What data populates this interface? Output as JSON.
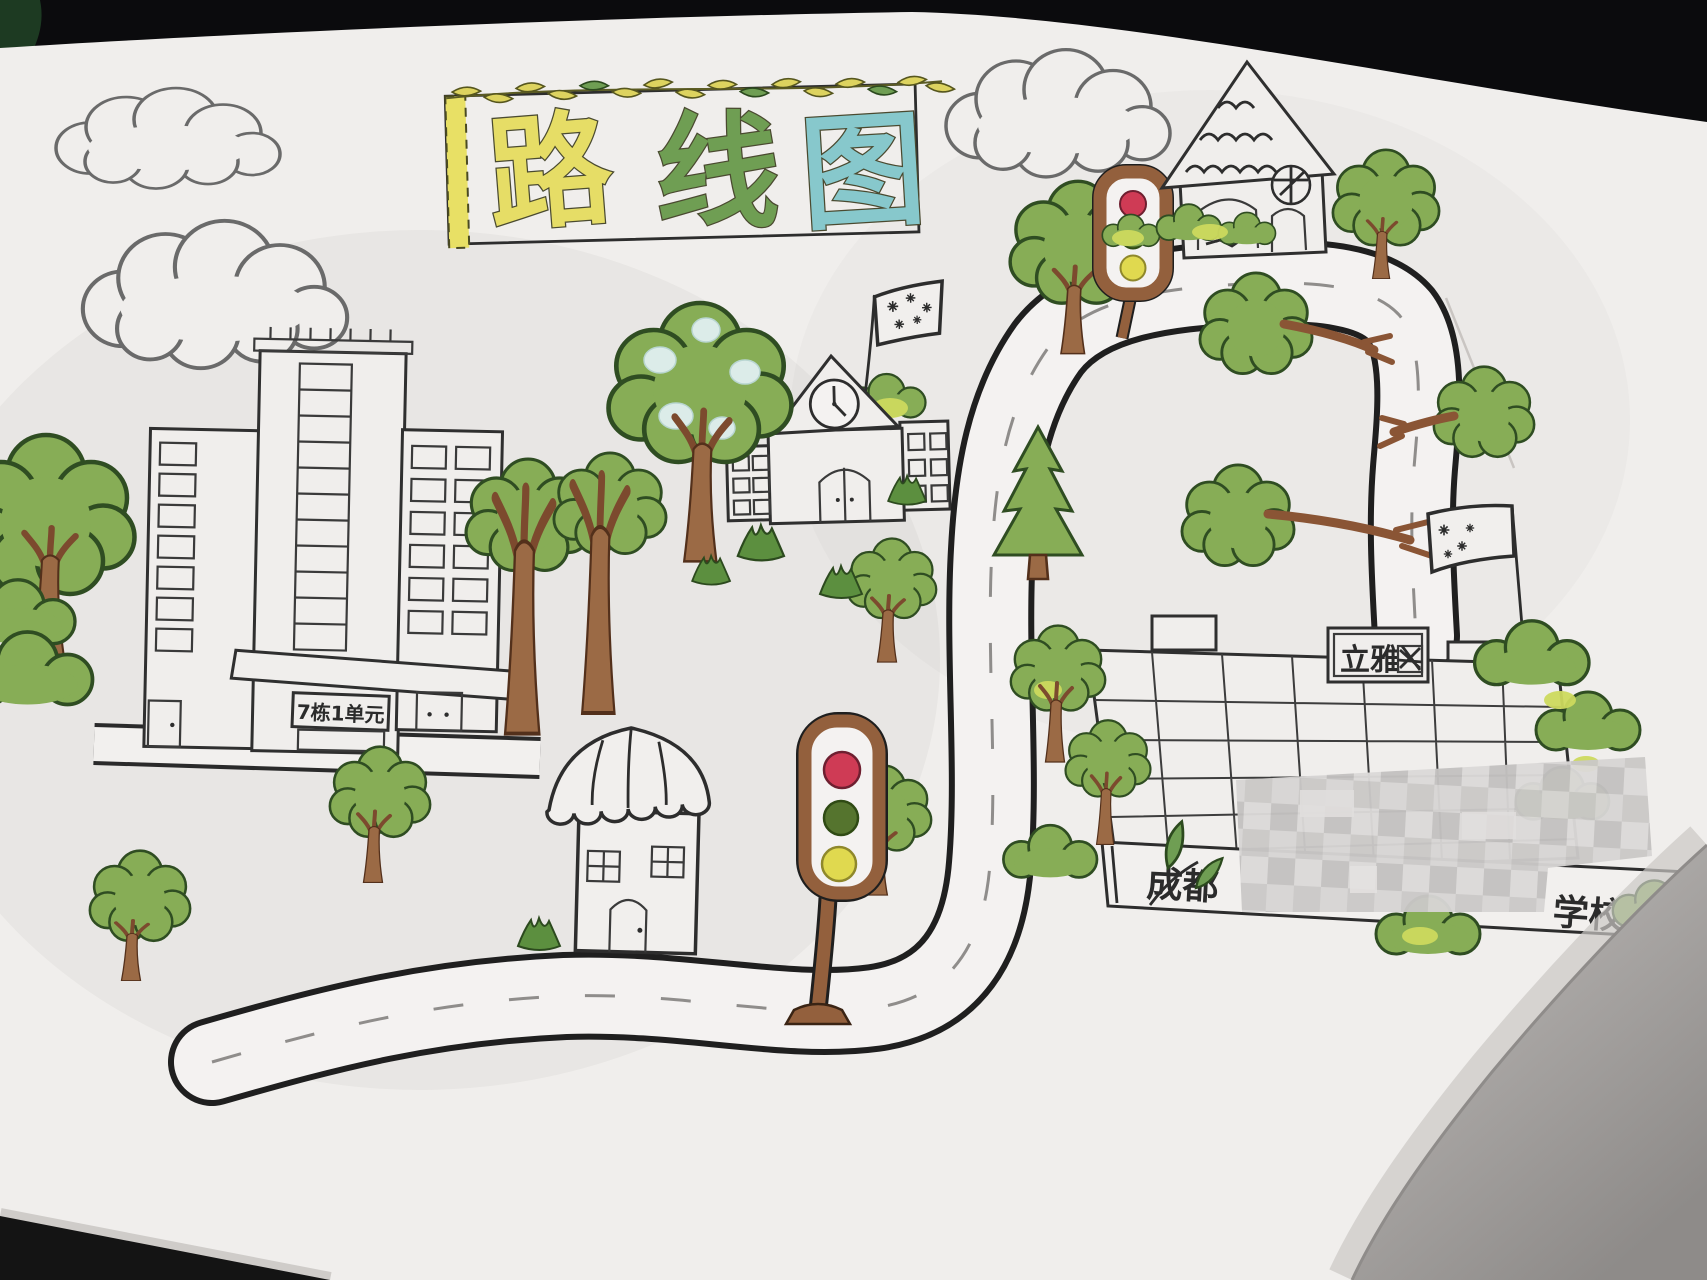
{
  "photo": {
    "description": "child's hand-drawn route map photographed on a dark table",
    "background_color": "#0b0b0d",
    "paper_color": "#f0eeec"
  },
  "title": {
    "text": "路线图",
    "chars": [
      {
        "char": "路",
        "color": "#e6dd66"
      },
      {
        "char": "线",
        "color": "#6f9e53"
      },
      {
        "char": "图",
        "color": "#87c8cc"
      }
    ]
  },
  "signs": {
    "apartment": "7栋1单元",
    "rooftop": "立雅",
    "rooftop_note": "third character scribbled out",
    "gate_prefix": "成都",
    "gate_middle": "censored with pixel mosaic",
    "gate_suffix": "学校"
  },
  "traffic_lights": {
    "count": 2,
    "order_top_to_bottom": [
      "red",
      "green",
      "yellow"
    ],
    "colors": {
      "red": "#cf3b55",
      "green": "#55742e",
      "yellow": "#e0d94f",
      "frame_brown": "#93603d"
    }
  },
  "palette": {
    "ink": "#2d2d2d",
    "tree_green": "#87ad56",
    "bush_yellow_green": "#ccd95e",
    "trunk_brown": "#9b6a45",
    "road_fill": "#f4f2f1",
    "corner_shadow": "#a8a5a3"
  }
}
